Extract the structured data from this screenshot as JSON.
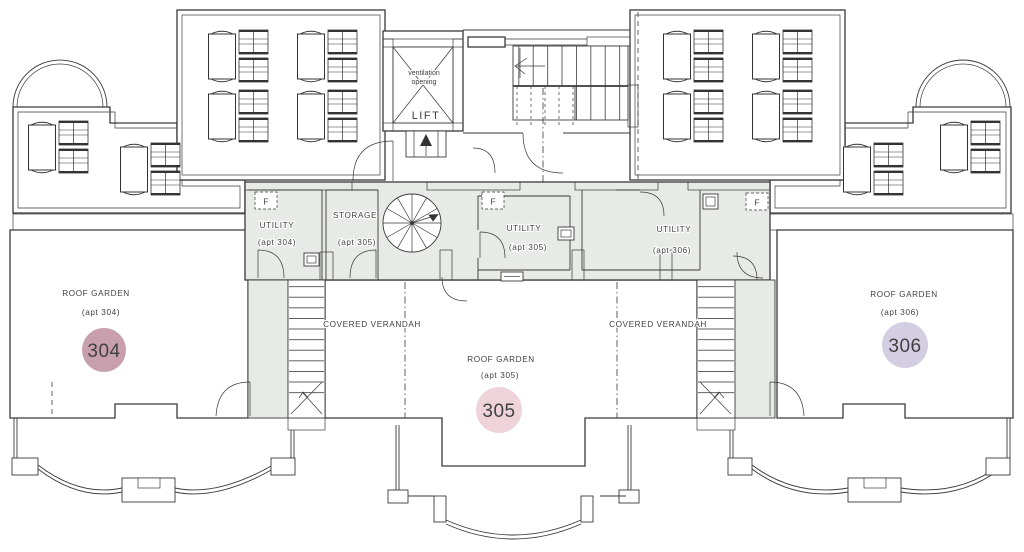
{
  "drawing": {
    "lift": {
      "vent_line1": "ventilation",
      "vent_line2": "opening",
      "label": "LIFT"
    },
    "fire_label": "F",
    "rooms": [
      {
        "name": "UTILITY",
        "apt": "(apt 304)"
      },
      {
        "name": "STORAGE",
        "apt": "(apt 305)"
      },
      {
        "name": "UTILITY",
        "apt": "(apt 305)"
      },
      {
        "name": "UTILITY",
        "apt": "(apt 306)"
      }
    ],
    "verandah_left": "COVERED VERANDAH",
    "verandah_right": "COVERED VERANDAH",
    "gardens": [
      {
        "label": "ROOF GARDEN",
        "apt": "(apt 304)",
        "number": "304",
        "badge_color": "#c89fad"
      },
      {
        "label": "ROOF GARDEN",
        "apt": "(apt 305)",
        "number": "305",
        "badge_color": "#eed3da"
      },
      {
        "label": "ROOF GARDEN",
        "apt": "(apt 306)",
        "number": "306",
        "badge_color": "#d3cee2"
      }
    ]
  },
  "colors": {
    "line": "#3a3a3a",
    "room_fill": "#e8eae7",
    "text": "#414141"
  }
}
